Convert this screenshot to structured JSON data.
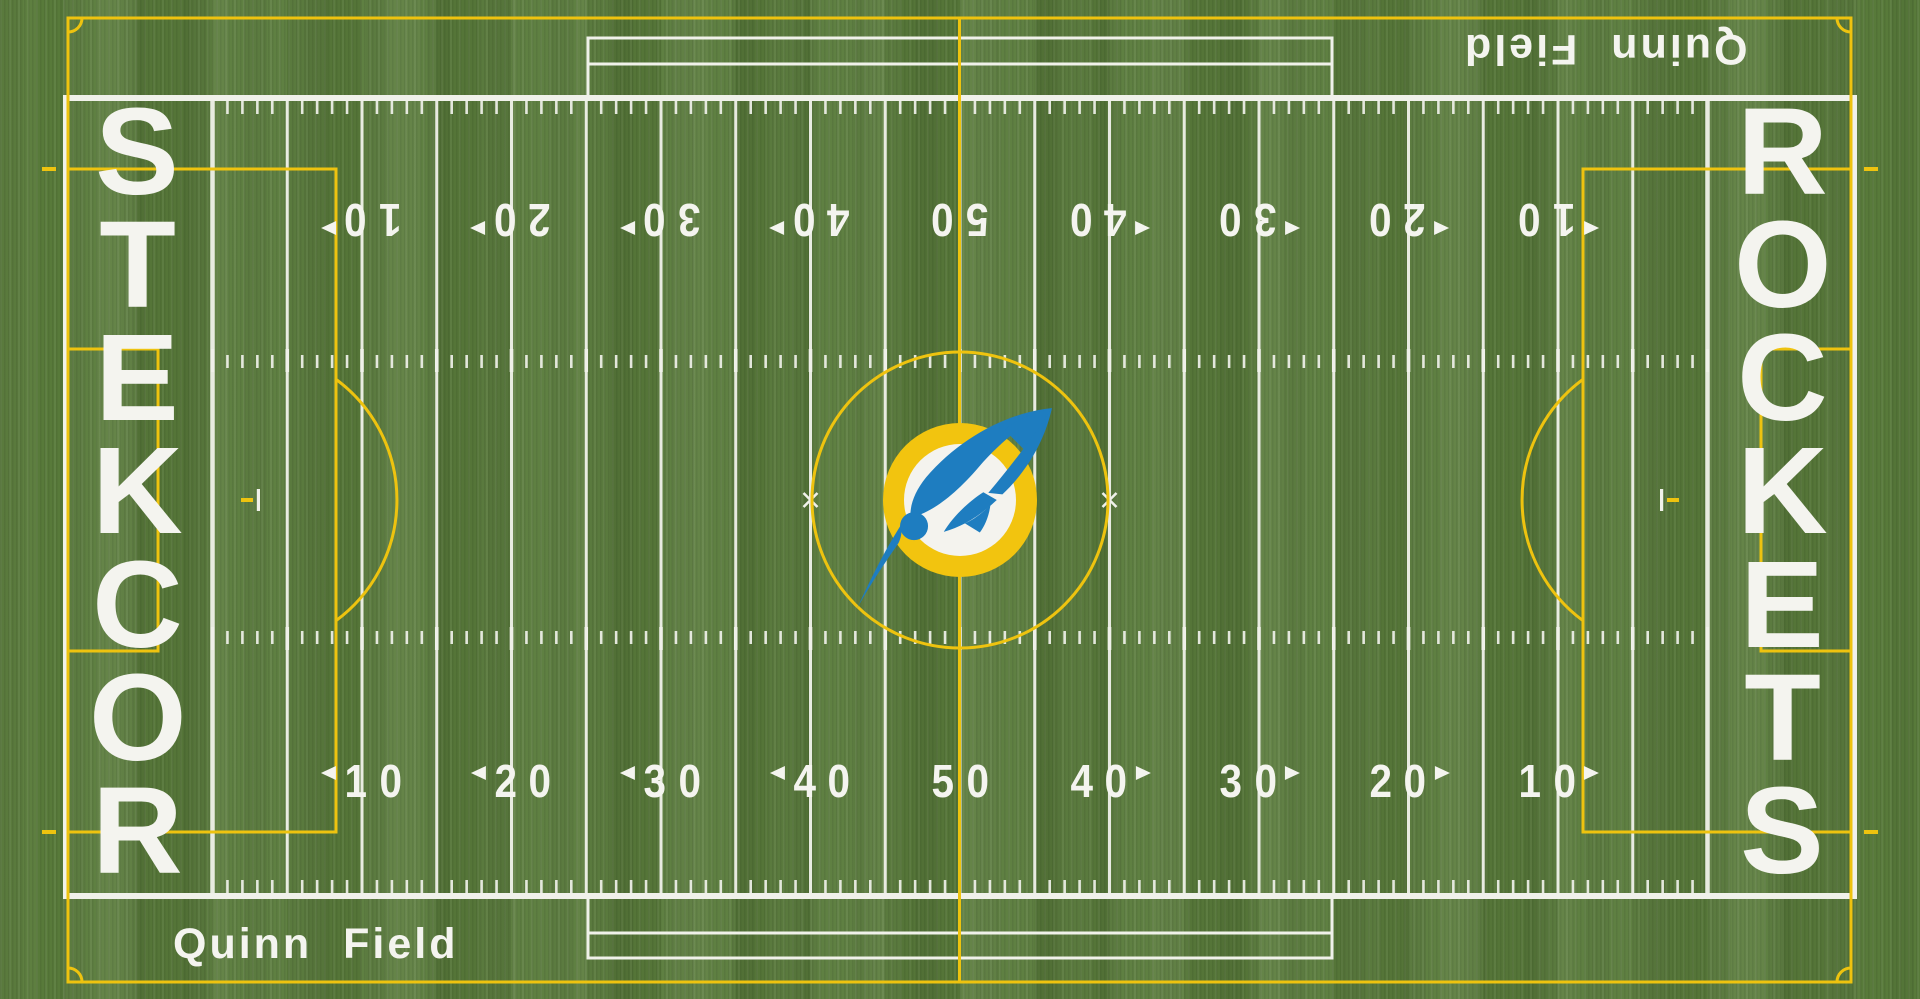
{
  "scene": {
    "description": "Aerial view of a football field with soccer pitch overlay",
    "team_name": "ROCKETS",
    "field_name": "Quinn Field",
    "endzone_left_letters": [
      "S",
      "T",
      "E",
      "K",
      "C",
      "O",
      "R"
    ],
    "endzone_right_letters": [
      "R",
      "O",
      "C",
      "K",
      "E",
      "T",
      "S"
    ],
    "yard_numbers": [
      {
        "label": "10",
        "arrow": "left"
      },
      {
        "label": "20",
        "arrow": "left"
      },
      {
        "label": "30",
        "arrow": "left"
      },
      {
        "label": "40",
        "arrow": "left"
      },
      {
        "label": "50",
        "arrow": "none"
      },
      {
        "label": "40",
        "arrow": "right"
      },
      {
        "label": "30",
        "arrow": "right"
      },
      {
        "label": "20",
        "arrow": "right"
      },
      {
        "label": "10",
        "arrow": "right"
      }
    ],
    "colors": {
      "turf_green": "#5a7c3b",
      "line_white": "#f0f1ea",
      "pitch_yellow": "#eec30f",
      "logo_disc_yellow": "#f2c40f",
      "logo_disc_white": "#f4f3ee",
      "rocket_blue": "#1e7dc0"
    }
  }
}
